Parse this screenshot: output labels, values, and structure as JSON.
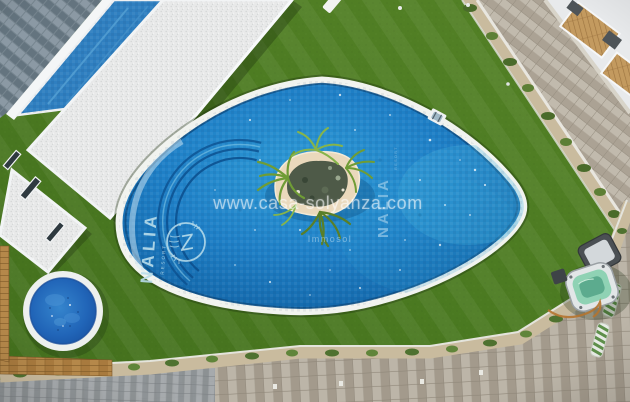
{
  "watermarks": {
    "site": "www.casa-solyanza.com",
    "agency": "Immosol",
    "resort_vertical": "NALIA",
    "resort_vertical_sub": "RESORT"
  },
  "pool_mosaic_logo": {
    "name": "NALIA",
    "subtitle": "RESORT",
    "monogram": "Z"
  },
  "colors": {
    "grass": "#4b7a21",
    "grass_light": "#558227",
    "grass_dark": "#436f1d",
    "pool_water": "#1f80c7",
    "pool_water_light": "#49b6e2",
    "pool_water_deep": "#0f5c9c",
    "pool_coping": "#f1f3ef",
    "lane_line": "#0b4e8c",
    "island_rim": "#ead9bc",
    "island_center": "#4e5a48",
    "palm_green": "#74a33c",
    "kids_pool_water": "#2165b8",
    "jacuzzi_water": "#8fd2b4",
    "jacuzzi_cover": "#4b5054",
    "walkway_pavers": "#b6afa2",
    "plant_soil": "#c9bb9e",
    "shrub_green": "#4a6b2a",
    "wood_edge": "#a87a3e",
    "slate_roof": "#76858f",
    "building_white": "#eef0f2",
    "gravel_roof": "#e8e9e9",
    "lap_pool_strip": "#2f7fc0",
    "watermark_text": "rgba(255,255,255,0.55)"
  }
}
